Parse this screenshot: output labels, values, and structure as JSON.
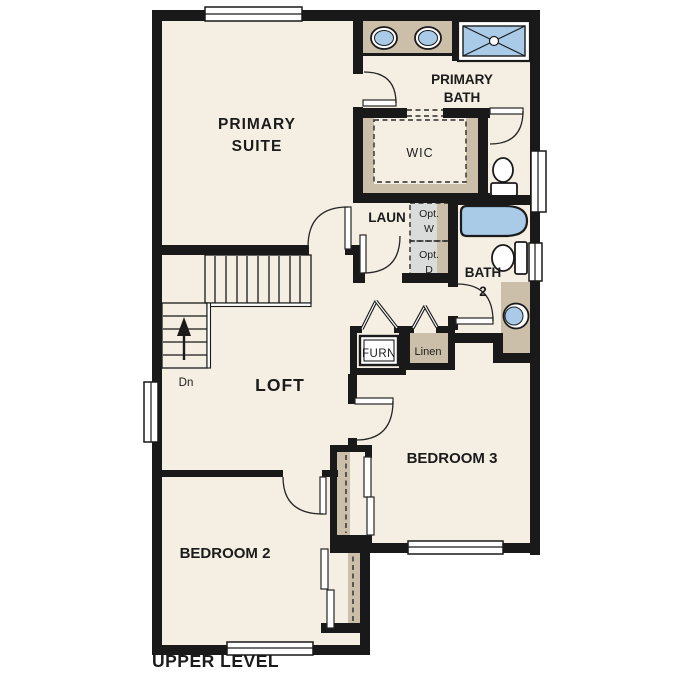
{
  "title": "UPPER LEVEL",
  "colors": {
    "paper": "#FFFFFF",
    "floor": "#F5EEE3",
    "wall": "#191919",
    "fixture_blue": "#A9CBE8",
    "cabinet_tan": "#CBBFAA",
    "appliance_gray": "#D9DCDB",
    "text": "#1B1B1B"
  },
  "rooms": {
    "primary_suite": {
      "line1": "PRIMARY",
      "line2": "SUITE"
    },
    "primary_bath": {
      "line1": "PRIMARY",
      "line2": "BATH"
    },
    "wic": {
      "label": "WIC"
    },
    "laundry": {
      "label": "LAUN"
    },
    "opt_washer": {
      "line1": "Opt.",
      "line2": "W"
    },
    "opt_dryer": {
      "line1": "Opt.",
      "line2": "D"
    },
    "bath2": {
      "line1": "BATH",
      "line2": "2"
    },
    "linen": {
      "label": "Linen"
    },
    "furnace": {
      "label": "FURN"
    },
    "loft": {
      "label": "LOFT"
    },
    "bedroom2": {
      "label": "BEDROOM 2"
    },
    "bedroom3": {
      "label": "BEDROOM 3"
    }
  },
  "stairs": {
    "down_label": "Dn"
  }
}
